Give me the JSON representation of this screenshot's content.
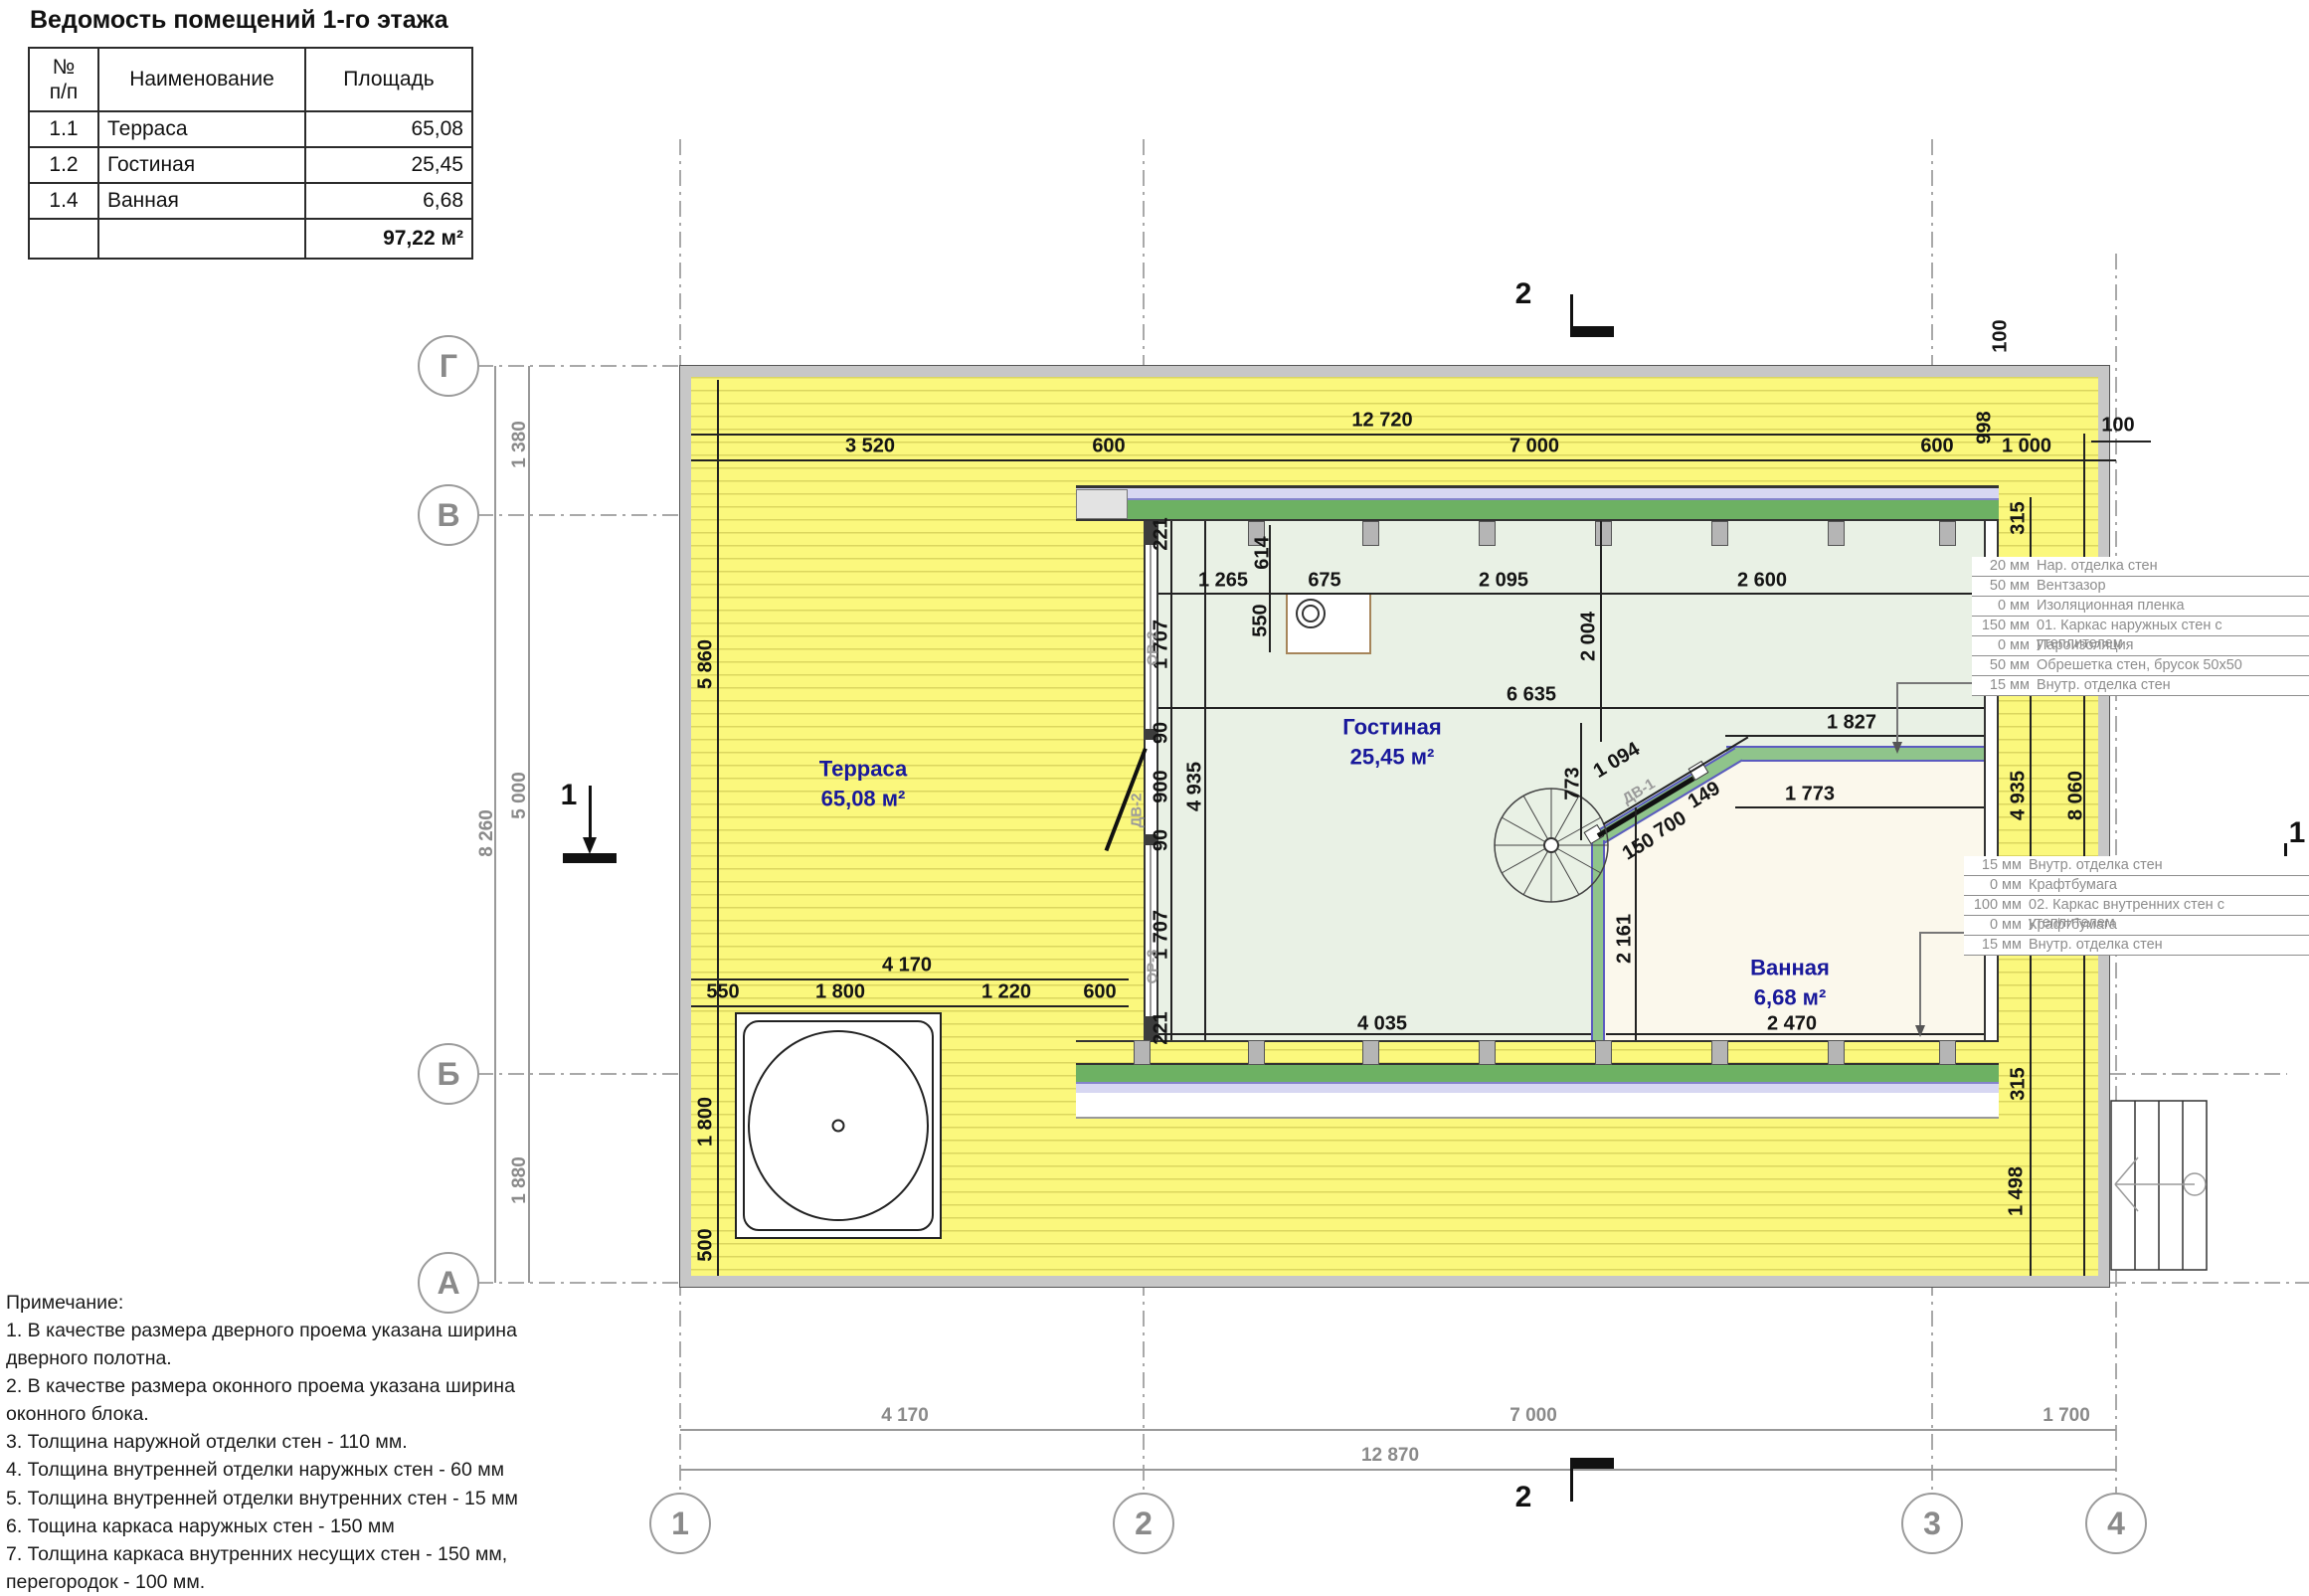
{
  "schedule": {
    "title": "Ведомость помещений 1-го этажа",
    "headers": [
      "№\nп/п",
      "Наименование",
      "Площадь"
    ],
    "rows": [
      {
        "no": "1.1",
        "name": "Терраса",
        "area": "65,08"
      },
      {
        "no": "1.2",
        "name": "Гостиная",
        "area": "25,45"
      },
      {
        "no": "1.4",
        "name": "Ванная",
        "area": "6,68"
      }
    ],
    "total": "97,22 м²"
  },
  "rooms": [
    {
      "name": "Терраса",
      "area": "65,08 м²"
    },
    {
      "name": "Гостиная",
      "area": "25,45 м²"
    },
    {
      "name": "Ванная",
      "area": "6,68 м²"
    }
  ],
  "openings": [
    "ОР-2",
    "ДВ-2",
    "ОР-3",
    "ДВ-1"
  ],
  "axes": {
    "rows": [
      "Г",
      "В",
      "Б",
      "А"
    ],
    "cols": [
      "1",
      "2",
      "3",
      "4"
    ]
  },
  "sections": {
    "s1": "1",
    "s2": "2"
  },
  "dims": {
    "top": [
      "12 720",
      "3 520",
      "600",
      "7 000",
      "600",
      "998",
      "1 000",
      "100",
      "100"
    ],
    "left": [
      "1 380",
      "5 000",
      "1 880",
      "8 260"
    ],
    "bottom": [
      "4 170",
      "7 000",
      "1 700",
      "12 870"
    ],
    "terrace": [
      "5 860",
      "1 800",
      "500",
      "4 170",
      "550",
      "1 800",
      "1 220",
      "600"
    ],
    "wall_left": [
      "221",
      "1 707",
      "90",
      "900",
      "90",
      "1 707",
      "221",
      "4 935"
    ],
    "interior": [
      "1 265",
      "614",
      "675",
      "550",
      "2 095",
      "2 004",
      "2 600",
      "6 635",
      "1 827",
      "1 773",
      "1 094",
      "150",
      "700",
      "149",
      "773",
      "2 161",
      "4 035",
      "2 470"
    ],
    "right": [
      "315",
      "4 935",
      "8 060",
      "315",
      "1 498"
    ]
  },
  "callouts": {
    "external": [
      [
        "20 мм",
        "Нар. отделка стен"
      ],
      [
        "50 мм",
        "Вентзазор"
      ],
      [
        "0 мм",
        "Изоляционная пленка"
      ],
      [
        "150 мм",
        "01. Каркас наружных стен с утеплителем"
      ],
      [
        "0 мм",
        "Пароизоляция"
      ],
      [
        "50 мм",
        "Обрешетка стен, брусок 50x50"
      ],
      [
        "15 мм",
        "Внутр. отделка стен"
      ]
    ],
    "internal": [
      [
        "15 мм",
        "Внутр. отделка стен"
      ],
      [
        "0 мм",
        "Крафтбумага"
      ],
      [
        "100 мм",
        "02. Каркас внутренних стен с утеплителем"
      ],
      [
        "0 мм",
        "Крафтбумага"
      ],
      [
        "15 мм",
        "Внутр. отделка стен"
      ]
    ]
  },
  "notes": [
    "Примечание:",
    "1. В качестве размера дверного проема указана ширина дверного полотна.",
    "2. В качестве размера оконного проема указана ширина оконного блока.",
    "3. Толщина наружной отделки стен - 110 мм.",
    "4. Толщина внутренней отделки наружных стен - 60 мм",
    "5. Толщина внутренней отделки внутренних стен - 15 мм",
    "6. Тощина каркаса наружных стен - 150 мм",
    "7. Толщина каркаса внутренних несущих стен - 150 мм, перегородок - 100 мм."
  ],
  "colors": {
    "terrace_yellow": "#fbf87d",
    "room_green": "#e9f1e5",
    "bath_cream": "#fbf8ec",
    "band_green": "#6db163",
    "band_lavender": "#d7d7f2",
    "wall_gray": "#c7c7c7",
    "label_navy": "#19199b",
    "dim_gray": "#8a8a8a"
  }
}
